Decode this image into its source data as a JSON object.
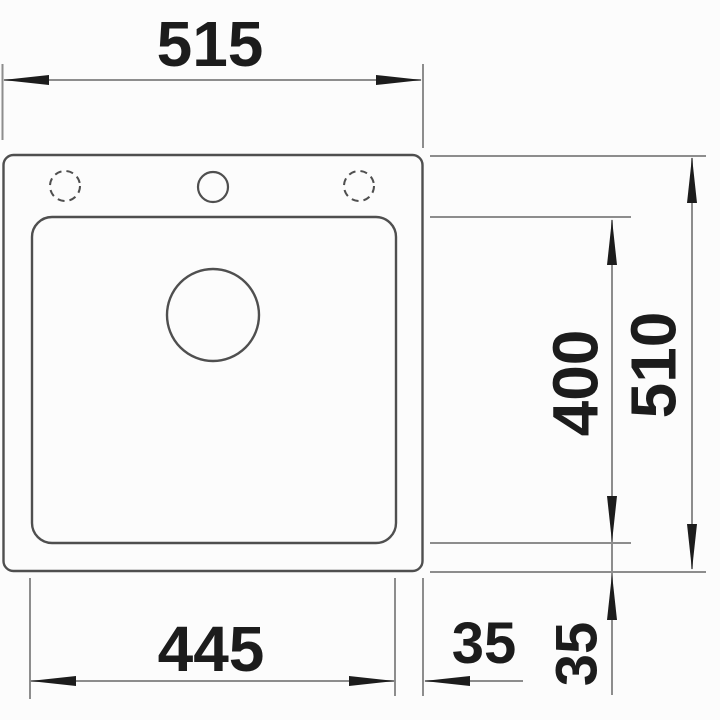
{
  "drawing": {
    "kind": "technical-dimension-drawing",
    "subject": "sink-top-view",
    "colors": {
      "object_line": "#4f4f4f",
      "dimension_line": "#8d8d8d",
      "arrow_and_text": "#1c1c1c",
      "background": "#fcfcfc"
    },
    "dimensions": {
      "overall_width": {
        "value": "515",
        "orientation": "horizontal",
        "position": "top"
      },
      "overall_depth": {
        "value": "510",
        "orientation": "vertical",
        "position": "right-outer"
      },
      "bowl_depth": {
        "value": "400",
        "orientation": "vertical",
        "position": "right-inner"
      },
      "bowl_width": {
        "value": "445",
        "orientation": "horizontal",
        "position": "bottom"
      },
      "right_offset": {
        "value": "35",
        "orientation": "horizontal",
        "position": "bottom-right"
      },
      "bottom_offset": {
        "value": "35",
        "orientation": "vertical",
        "position": "right-below"
      }
    },
    "features": {
      "tap_hole_center": "solid-circle",
      "tap_hole_left": "dashed-circle-optional",
      "tap_hole_right": "dashed-circle-optional",
      "drain": "circle"
    }
  }
}
